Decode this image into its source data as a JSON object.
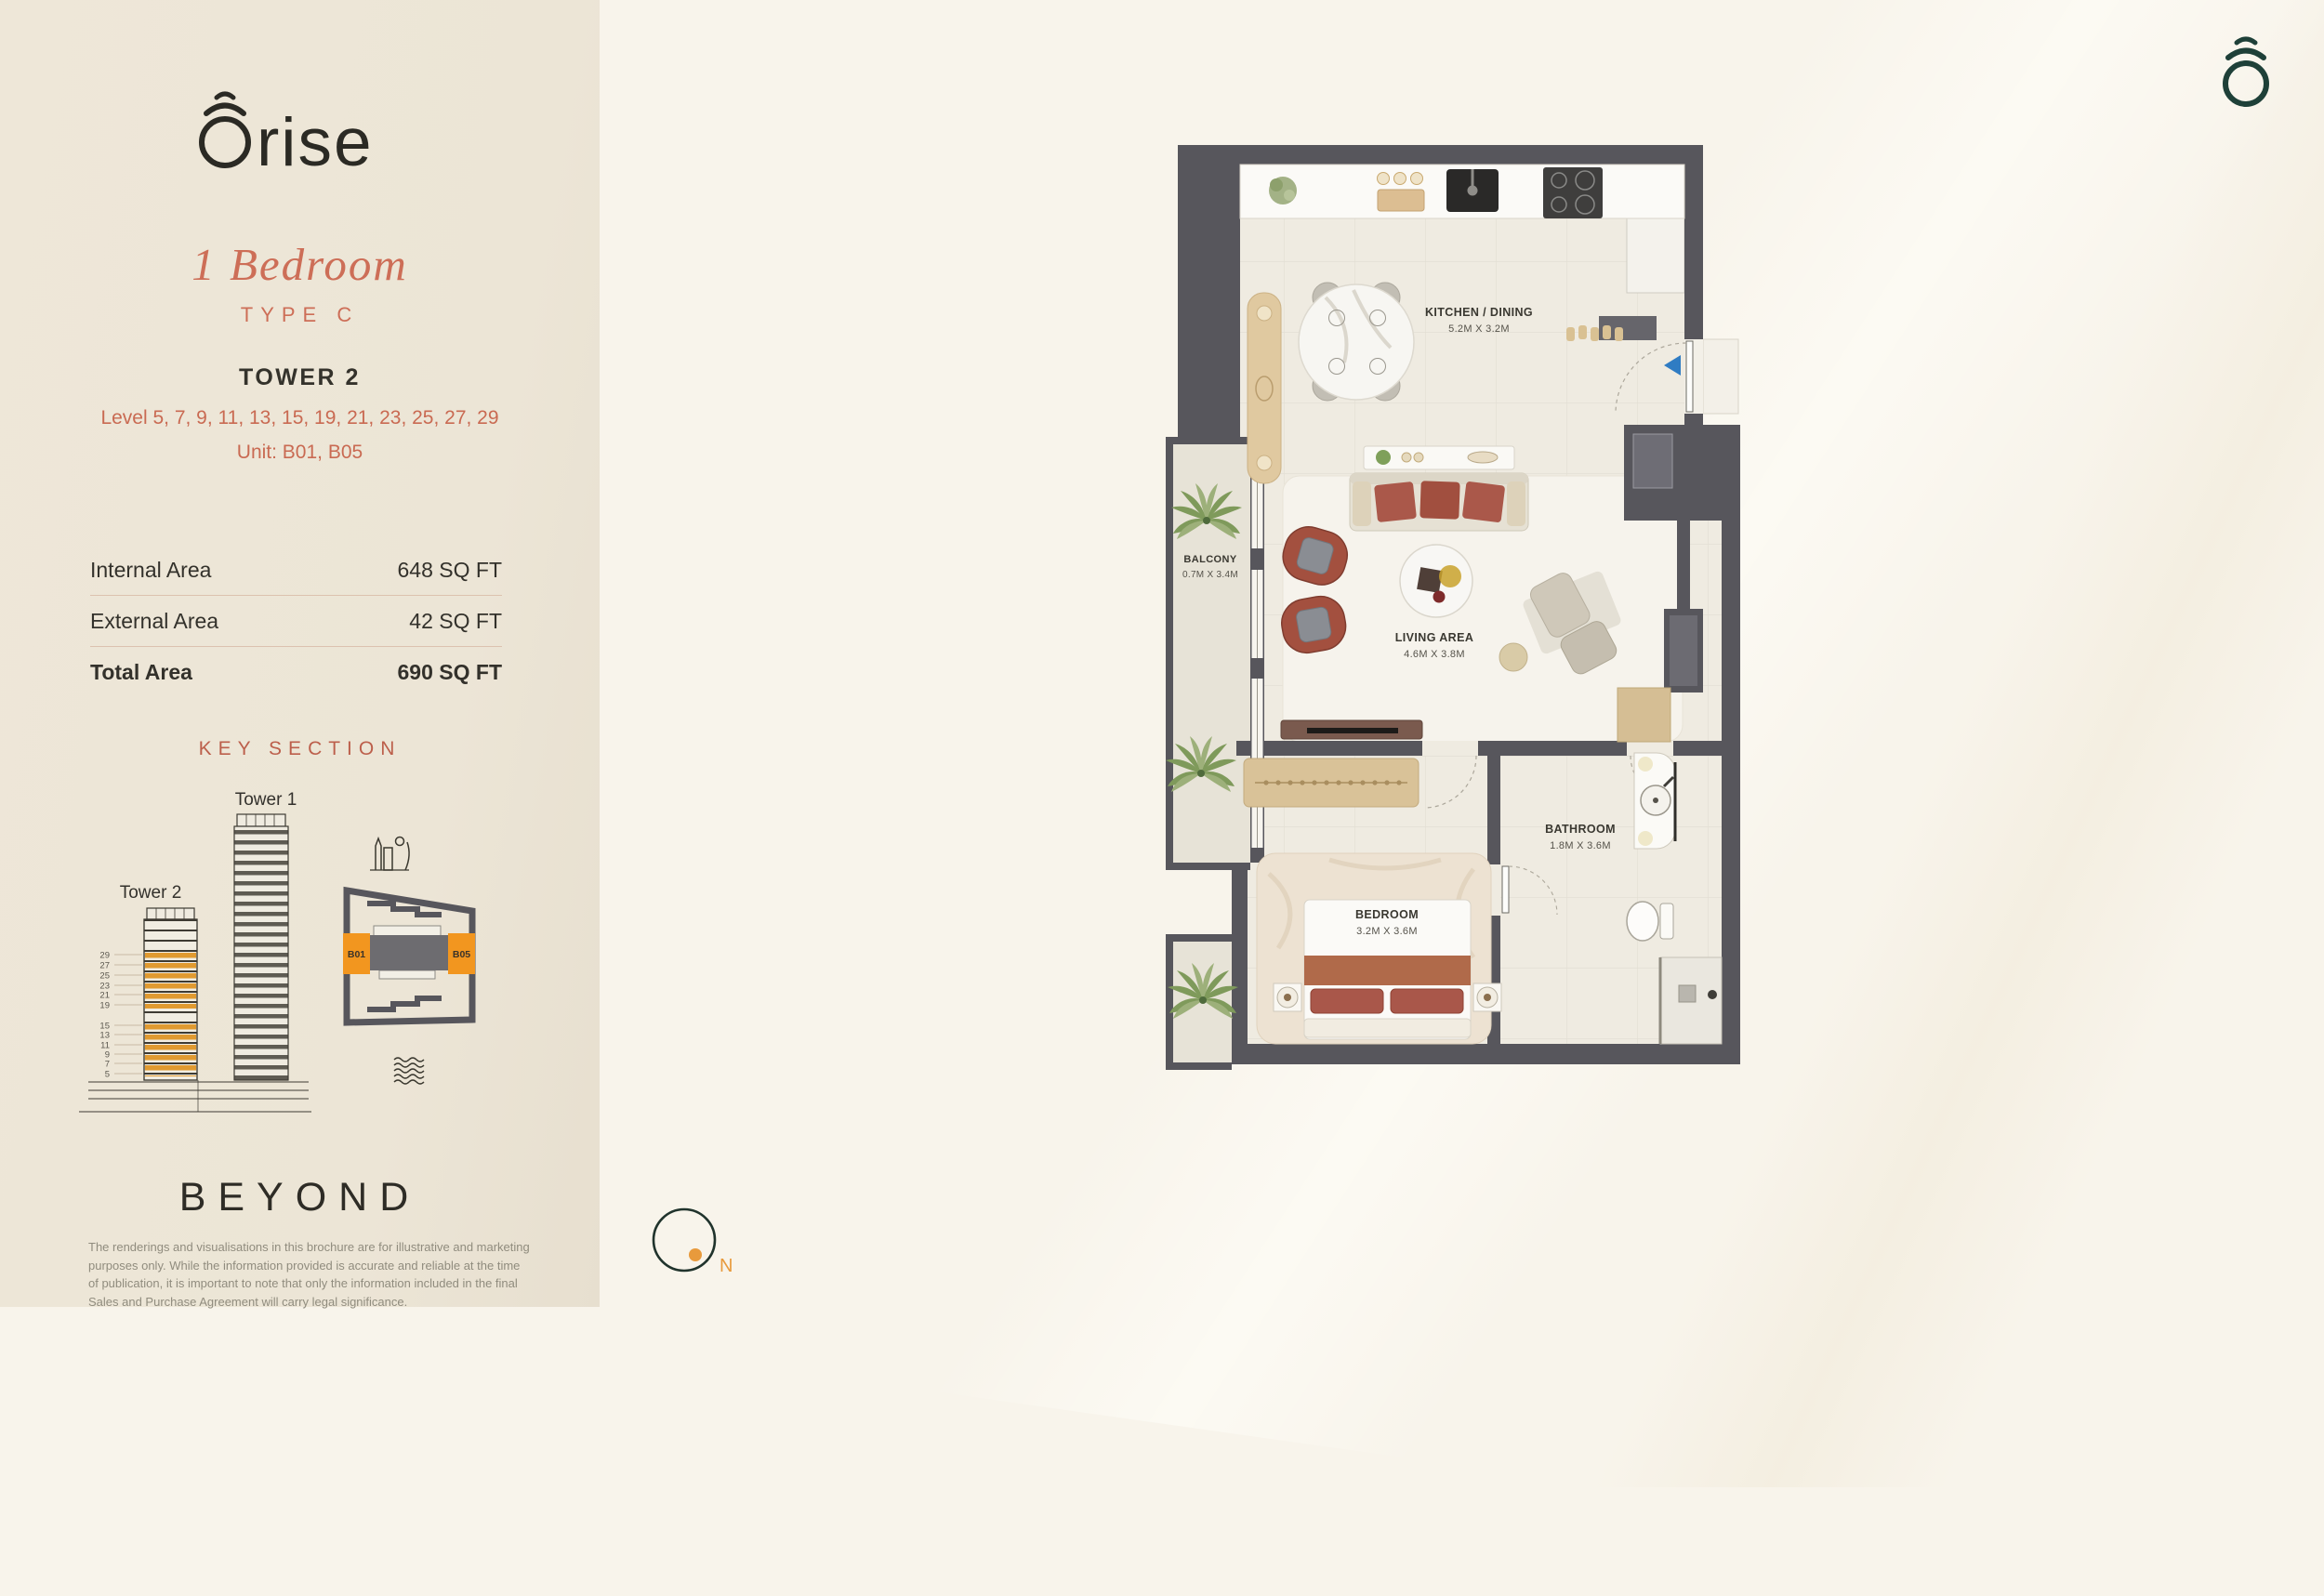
{
  "brand": {
    "logo_text": "rise"
  },
  "unit": {
    "type_title": "1 Bedroom",
    "type_sub": "TYPE C",
    "tower": "TOWER 2",
    "levels": "Level 5, 7, 9, 11, 13, 15, 19, 21, 23, 25, 27, 29",
    "units": "Unit: B01, B05"
  },
  "areas": {
    "rows": [
      {
        "label": "Internal Area",
        "value": "648 SQ FT"
      },
      {
        "label": "External Area",
        "value": "42 SQ FT"
      }
    ],
    "total": {
      "label": "Total Area",
      "value": "690 SQ FT"
    }
  },
  "key_section": {
    "title": "KEY SECTION",
    "tower1_label": "Tower 1",
    "tower2_label": "Tower 2",
    "floor_numbers": [
      "29",
      "27",
      "25",
      "23",
      "21",
      "19",
      "15",
      "13",
      "11",
      "9",
      "7",
      "5"
    ],
    "unit_left": "B01",
    "unit_right": "B05"
  },
  "plan": {
    "rooms": [
      {
        "name": "KITCHEN / DINING",
        "dims": "5.2M X 3.2M"
      },
      {
        "name": "BALCONY",
        "dims": "0.7M X 3.4M"
      },
      {
        "name": "LIVING AREA",
        "dims": "4.6M X 3.8M"
      },
      {
        "name": "BEDROOM",
        "dims": "3.2M X 3.6M"
      },
      {
        "name": "BATHROOM",
        "dims": "1.8M X 3.6M"
      }
    ]
  },
  "compass": {
    "label": "N"
  },
  "footer": {
    "brand": "BEYOND",
    "disclaimer": "The renderings and visualisations in this brochure are for illustrative and marketing purposes only. While the information provided is accurate and reliable at the time of publication, it is important to note that only the information included in the final Sales and Purchase Agreement will carry legal significance."
  },
  "colors": {
    "panel_bg": "#ece5d6",
    "page_bg": "#f8f4eb",
    "accent_coral": "#cd6e57",
    "accent_orange": "#f2961f",
    "wall_gray": "#57565c",
    "logo_green": "#1e4038",
    "terracotta": "#a9584a",
    "wood_tan": "#d8c094"
  }
}
